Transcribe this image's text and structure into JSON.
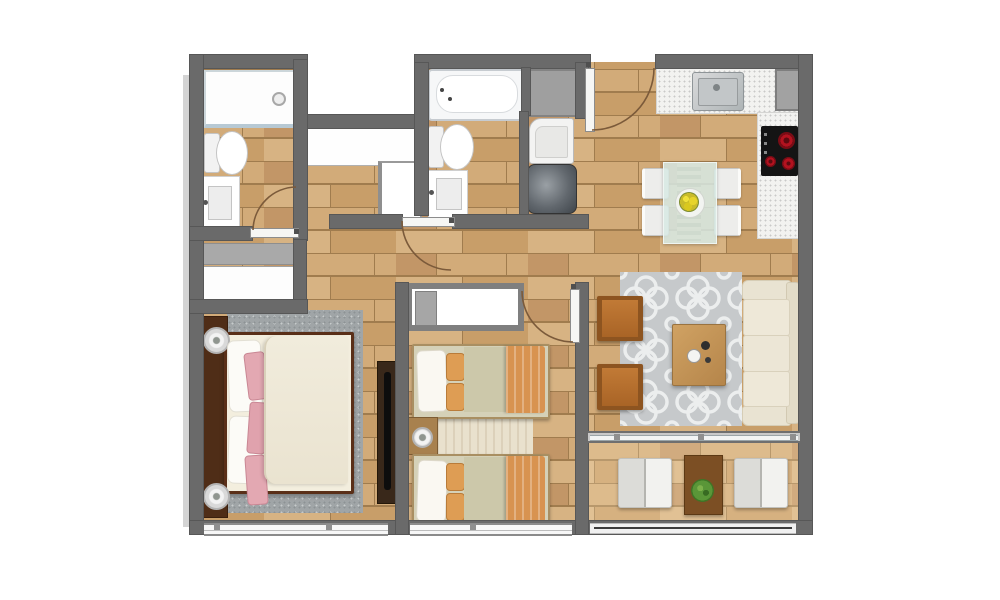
{
  "meta": {
    "type": "architectural floor plan, top-down 3D render",
    "unit_label": "2-bedroom, 2-bathroom apartment floor plan with terrace"
  },
  "palette": {
    "wall": "#6a6a6a",
    "floor_wood": "#cda572",
    "floor_line": "#a07c4e",
    "living_rug": "#c6c9cb",
    "bedroom_rug": "#a0a5a7",
    "sofa_cream": "#e9e3d2",
    "armchair_leather": "#b5702e",
    "coffee_table_wood": "#c89b5e",
    "blanket_orange": "#d89350",
    "sheet_sage": "#ccc8aa",
    "pillow_pink": "#e3a8b2",
    "bed_frame_mahogany": "#4f2d17",
    "counter_granite": "#f2f2f0",
    "cooktop_black": "#141414",
    "burner_red": "#b3121f",
    "plant_green": "#4e8f35",
    "terrace_table_brown": "#7c4f24",
    "glass_table": "#d7e9e4"
  },
  "rooms": {
    "bathroom_1": {
      "label": "Bathroom 1",
      "items": [
        "walk-in shower",
        "toilet",
        "vanity sink"
      ]
    },
    "hall_closet": {
      "label": "Hall closet",
      "items": [
        "gray shelf",
        "white wardrobe"
      ]
    },
    "bathroom_2": {
      "label": "Bathroom 2",
      "items": [
        "bathtub",
        "toilet",
        "vanity sink",
        "gray shower mat"
      ]
    },
    "laundry": {
      "label": "Laundry niche",
      "items": [
        "counter",
        "washing machine",
        "water heater"
      ]
    },
    "entry": {
      "label": "Entry",
      "items": [
        "entry door with swing"
      ]
    },
    "kitchen": {
      "label": "Kitchen",
      "items": [
        "L-shaped granite counter",
        "stainless sink",
        "cooktop with 3 burners",
        "refrigerator"
      ]
    },
    "dining": {
      "label": "Dining area",
      "items": [
        "glass dining table",
        "4 white chairs",
        "yellow flower centerpiece"
      ]
    },
    "living": {
      "label": "Living room",
      "items": [
        "cream 3-seat sofa",
        "2 leather armchairs",
        "wood coffee table",
        "gray trellis rug"
      ]
    },
    "master_bedroom": {
      "label": "Master bedroom",
      "items": [
        "double bed with pink pillows",
        "2 round bedside lamps",
        "gray area rug",
        "TV console"
      ]
    },
    "bedroom_2": {
      "label": "Bedroom 2",
      "items": [
        "2 twin beds with orange blankets",
        "built-in wardrobe",
        "nightstand with lamp",
        "cream runner rug"
      ]
    },
    "terrace": {
      "label": "Terrace",
      "items": [
        "2 folding lounge chairs",
        "brown side table",
        "potted plant",
        "railing"
      ]
    }
  },
  "doors": {
    "entry_door": "swings inward from top wall",
    "bathroom_1_door": "swings up into bathroom",
    "bathroom_2_door": "swings down into corridor",
    "bedroom_2_door": "swings into bedroom"
  },
  "windows": {
    "master_bedroom_window": "full-width sliding window, bottom wall",
    "bedroom_2_window": "sliding window, bottom wall",
    "living_sliding_door": "sliding glass door to terrace",
    "terrace_railing": "open railing at bottom edge"
  }
}
